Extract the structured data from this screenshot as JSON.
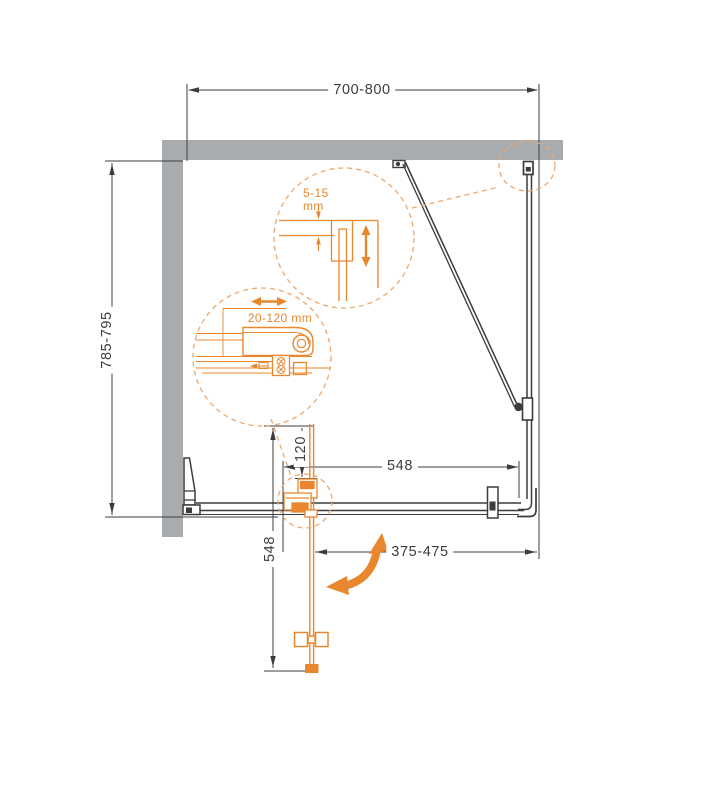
{
  "diagram": {
    "title": "shower-enclosure-installation-plan",
    "dimensions": {
      "top_width": "700-800",
      "left_depth": "785-795",
      "door_width_horizontal": "548",
      "door_width_vertical": "548",
      "pivot_offset": "120",
      "side_panel_range": "375-475"
    },
    "details": {
      "gap_adjustment_value": "5-15",
      "gap_adjustment_unit": "mm",
      "profile_adjustment": "20-120 mm"
    },
    "colors": {
      "accent_orange": "#e8872e",
      "dashed_orange": "#eda86e",
      "wall_gray": "#a9acae",
      "line_dark": "#3c3c3c"
    }
  }
}
